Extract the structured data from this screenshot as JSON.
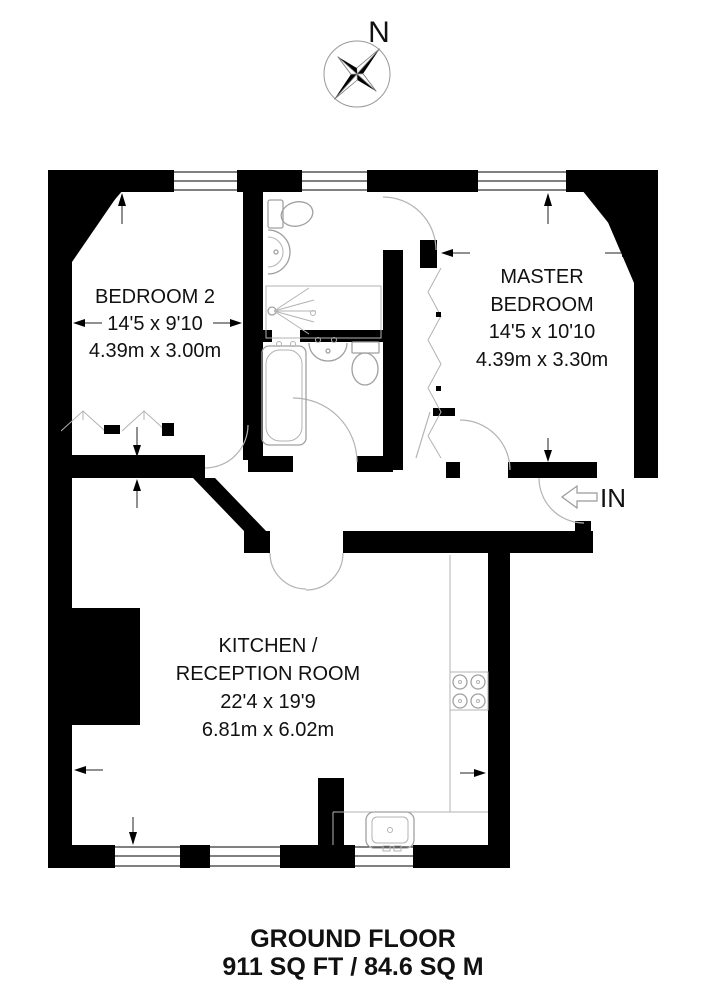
{
  "compass": {
    "north": "N"
  },
  "rooms": {
    "bedroom2": {
      "name": "BEDROOM 2",
      "imperial": "14'5 x 9'10",
      "metric": "4.39m x 3.00m"
    },
    "master": {
      "line1": "MASTER",
      "line2": "BEDROOM",
      "imperial": "14'5 x 10'10",
      "metric": "4.39m x 3.30m"
    },
    "kitchen": {
      "line1": "KITCHEN /",
      "line2": "RECEPTION ROOM",
      "imperial": "22'4 x 19'9",
      "metric": "6.81m x 6.02m"
    }
  },
  "entrance": {
    "label": "IN"
  },
  "footer": {
    "title": "GROUND FLOOR",
    "area": "911 SQ FT / 84.6 SQ M"
  },
  "colors": {
    "wall": "#000000",
    "fixture_line": "#a0a0a0",
    "text": "#111111"
  }
}
